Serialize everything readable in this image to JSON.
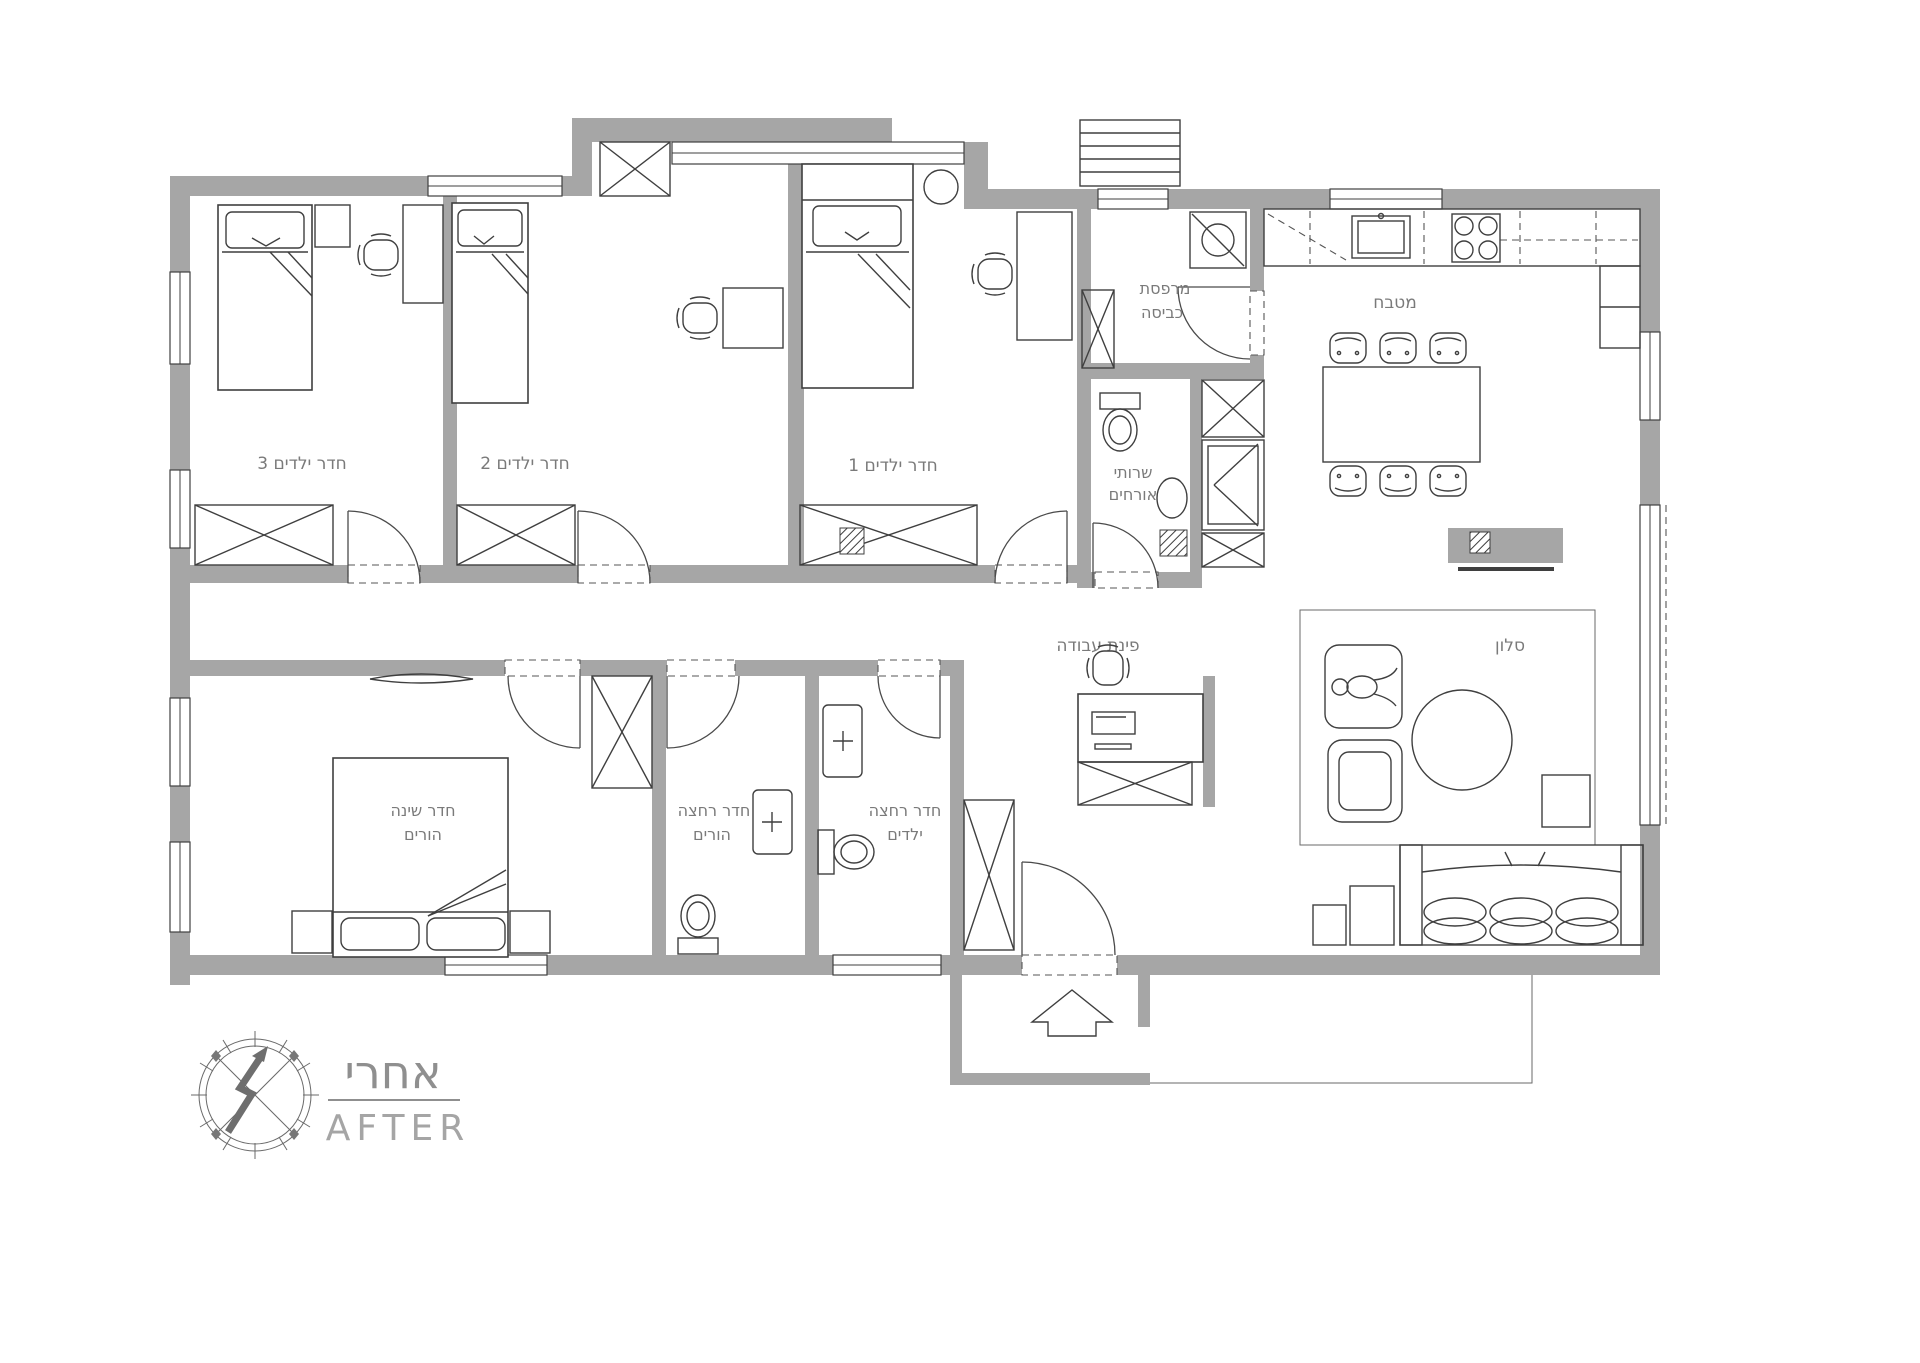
{
  "plan": {
    "rooms": {
      "kids3": {
        "label": "חדר ילדים 3"
      },
      "kids2": {
        "label": "חדר ילדים 2"
      },
      "kids1": {
        "label": "חדר ילדים 1"
      },
      "laundry": {
        "line1": "מרפסת",
        "line2": "כביסה"
      },
      "kitchen": {
        "label": "מטבח"
      },
      "guest_wc": {
        "line1": "שרותי",
        "line2": "אורחים"
      },
      "living": {
        "label": "סלון"
      },
      "work": {
        "label": "פינת עבודה"
      },
      "master": {
        "line1": "חדר שינה",
        "line2": "הורים"
      },
      "parents_bath": {
        "line1": "חדר רחצה",
        "line2": "הורים"
      },
      "kids_bath": {
        "line1": "חדר רחצה",
        "line2": "ילדים"
      }
    },
    "stamp": {
      "title_he": "אחרי",
      "title_en": "AFTER"
    },
    "colors": {
      "wall": "#a6a6a6",
      "line": "#3f3f3f",
      "label": "#7a7a7a",
      "stamp": "#8f8f8f"
    }
  }
}
